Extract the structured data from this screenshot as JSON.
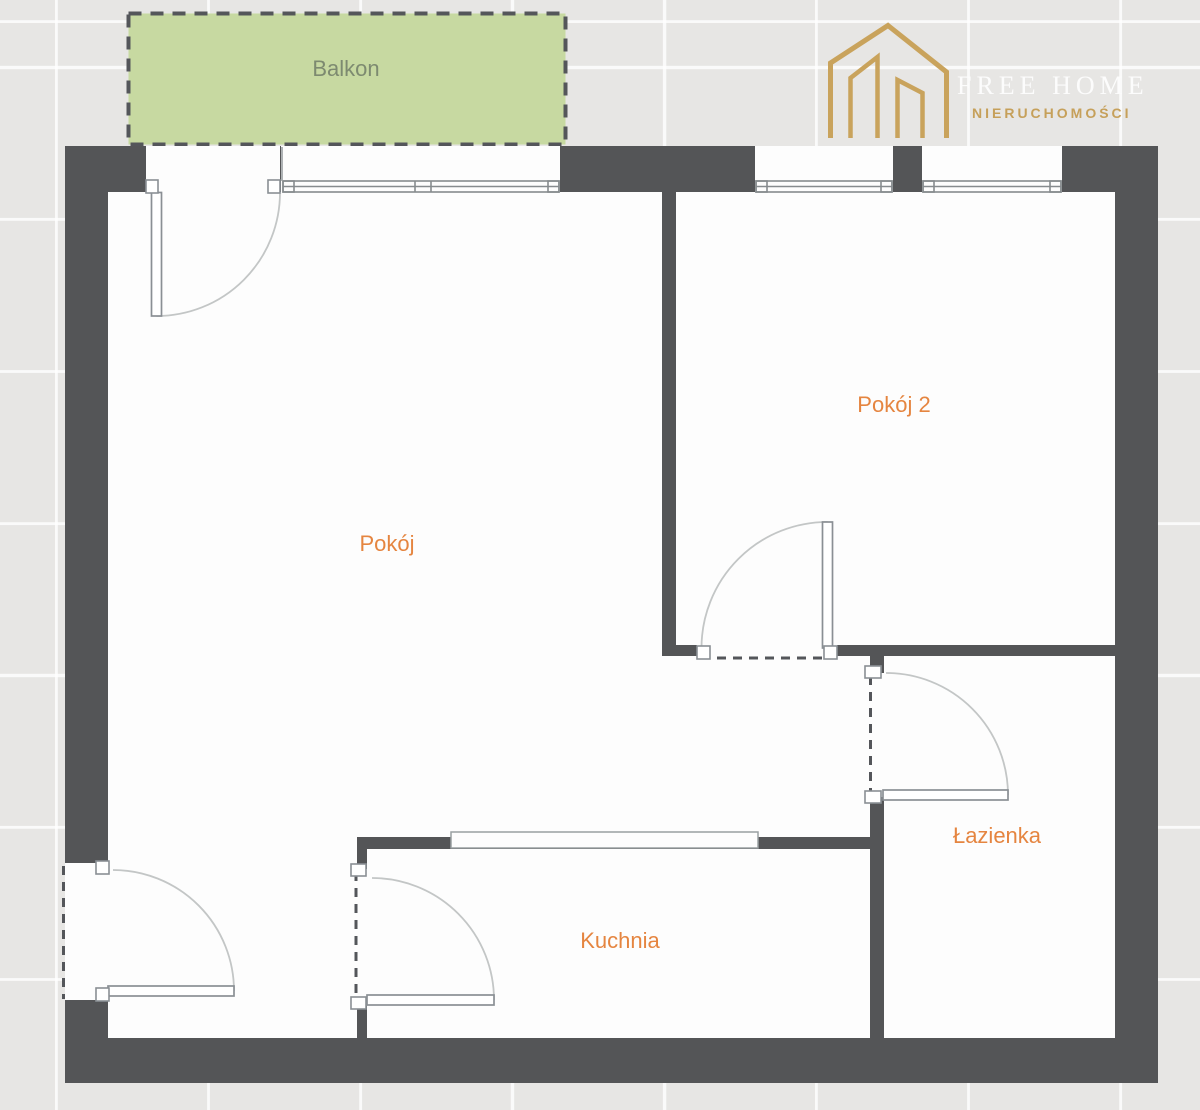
{
  "rooms": [
    {
      "id": "balkon",
      "label": "Balkon"
    },
    {
      "id": "pokoj",
      "label": "Pokój"
    },
    {
      "id": "pokoj2",
      "label": "Pokój 2"
    },
    {
      "id": "lazienka",
      "label": "Łazienka"
    },
    {
      "id": "kuchnia",
      "label": "Kuchnia"
    }
  ],
  "logo": {
    "title": "FREE HOME",
    "subtitle": "NIERUCHOMOŚCI"
  },
  "colors": {
    "background_tile": "#e7e6e4",
    "tile_line": "#f8f8f7",
    "wall": "#545557",
    "room_fill": "#fdfdfd",
    "balcony_fill": "#c7d9a1",
    "balcony_text": "#7d8a70",
    "room_label": "#e58540",
    "logo_gold": "#c6a05a",
    "logo_title": "#fcfcfc",
    "thin_line": "#8a8f94",
    "arc_line": "#c3c6c6"
  }
}
